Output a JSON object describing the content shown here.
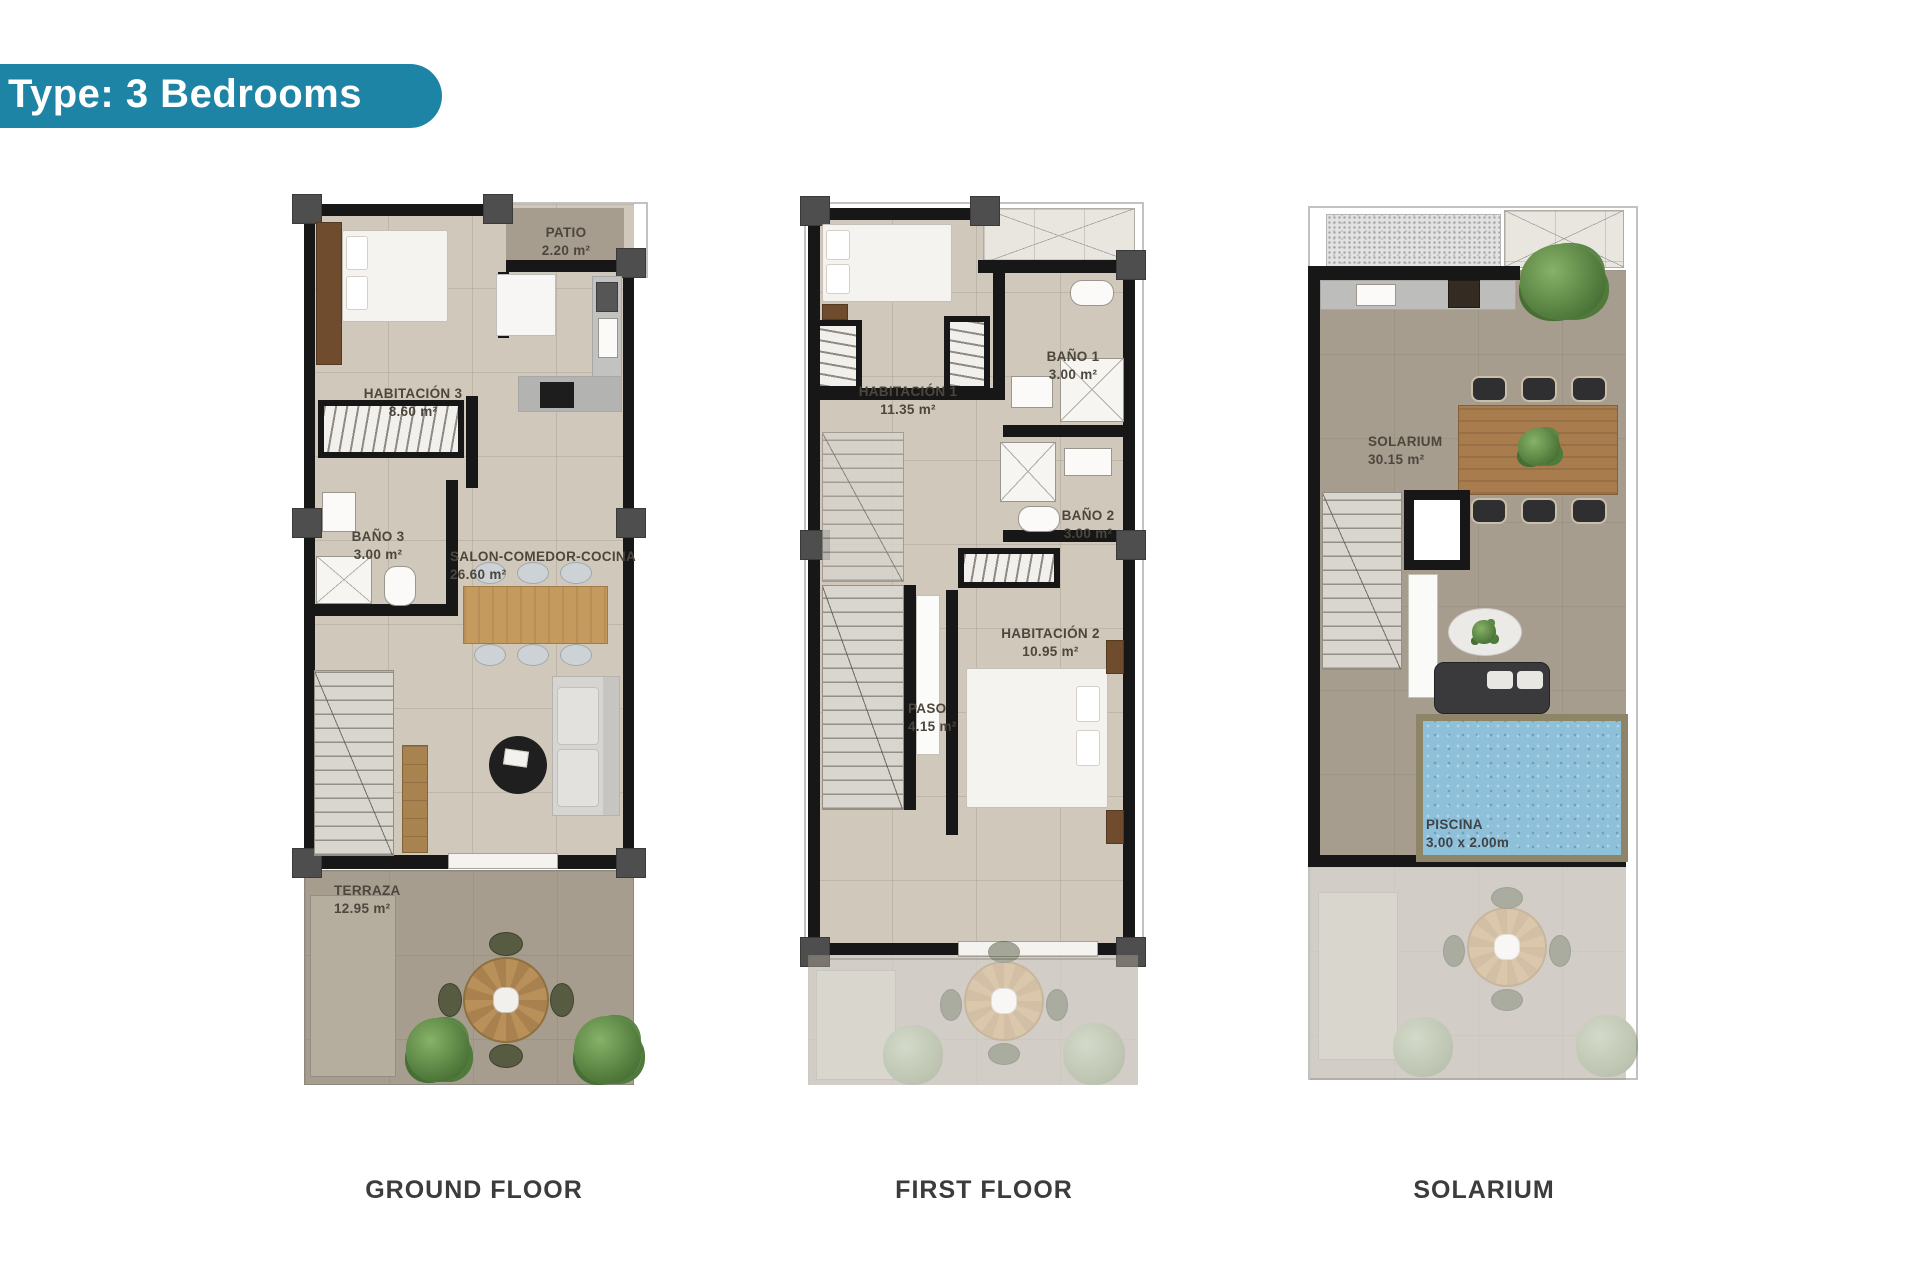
{
  "header": {
    "badge": "Type: 3 Bedrooms"
  },
  "colors": {
    "accent_teal": "#1e84a5",
    "wall_black": "#171717",
    "floor_beige": "#d0c9bb",
    "floor_taupe": "#a69d8f",
    "pool_blue": "#8fc0da",
    "wood": "#c59a5e",
    "plant_green": "#557f3f",
    "caption_gray": "#3c3c3c"
  },
  "plans": [
    {
      "id": "ground-floor",
      "caption": "GROUND FLOOR",
      "rooms": [
        {
          "name": "PATIO",
          "area": "2.20 m²"
        },
        {
          "name": "HABITACIÓN 3",
          "area": "8.60 m²"
        },
        {
          "name": "BAÑO 3",
          "area": "3.00 m²"
        },
        {
          "name": "SALON-COMEDOR-COCINA",
          "area": "26.60 m²"
        },
        {
          "name": "TERRAZA",
          "area": "12.95 m²"
        }
      ]
    },
    {
      "id": "first-floor",
      "caption": "FIRST FLOOR",
      "rooms": [
        {
          "name": "HABITACIÓN 1",
          "area": "11.35 m²"
        },
        {
          "name": "BAÑO 1",
          "area": "3.00 m²"
        },
        {
          "name": "BAÑO 2",
          "area": "3.00 m²"
        },
        {
          "name": "HABITACIÓN 2",
          "area": "10.95 m²"
        },
        {
          "name": "PASO",
          "area": "4.15 m²"
        }
      ]
    },
    {
      "id": "solarium",
      "caption": "SOLARIUM",
      "rooms": [
        {
          "name": "SOLARIUM",
          "area": "30.15 m²"
        },
        {
          "name": "PISCINA",
          "area": "3.00 x 2.00m"
        }
      ]
    }
  ]
}
